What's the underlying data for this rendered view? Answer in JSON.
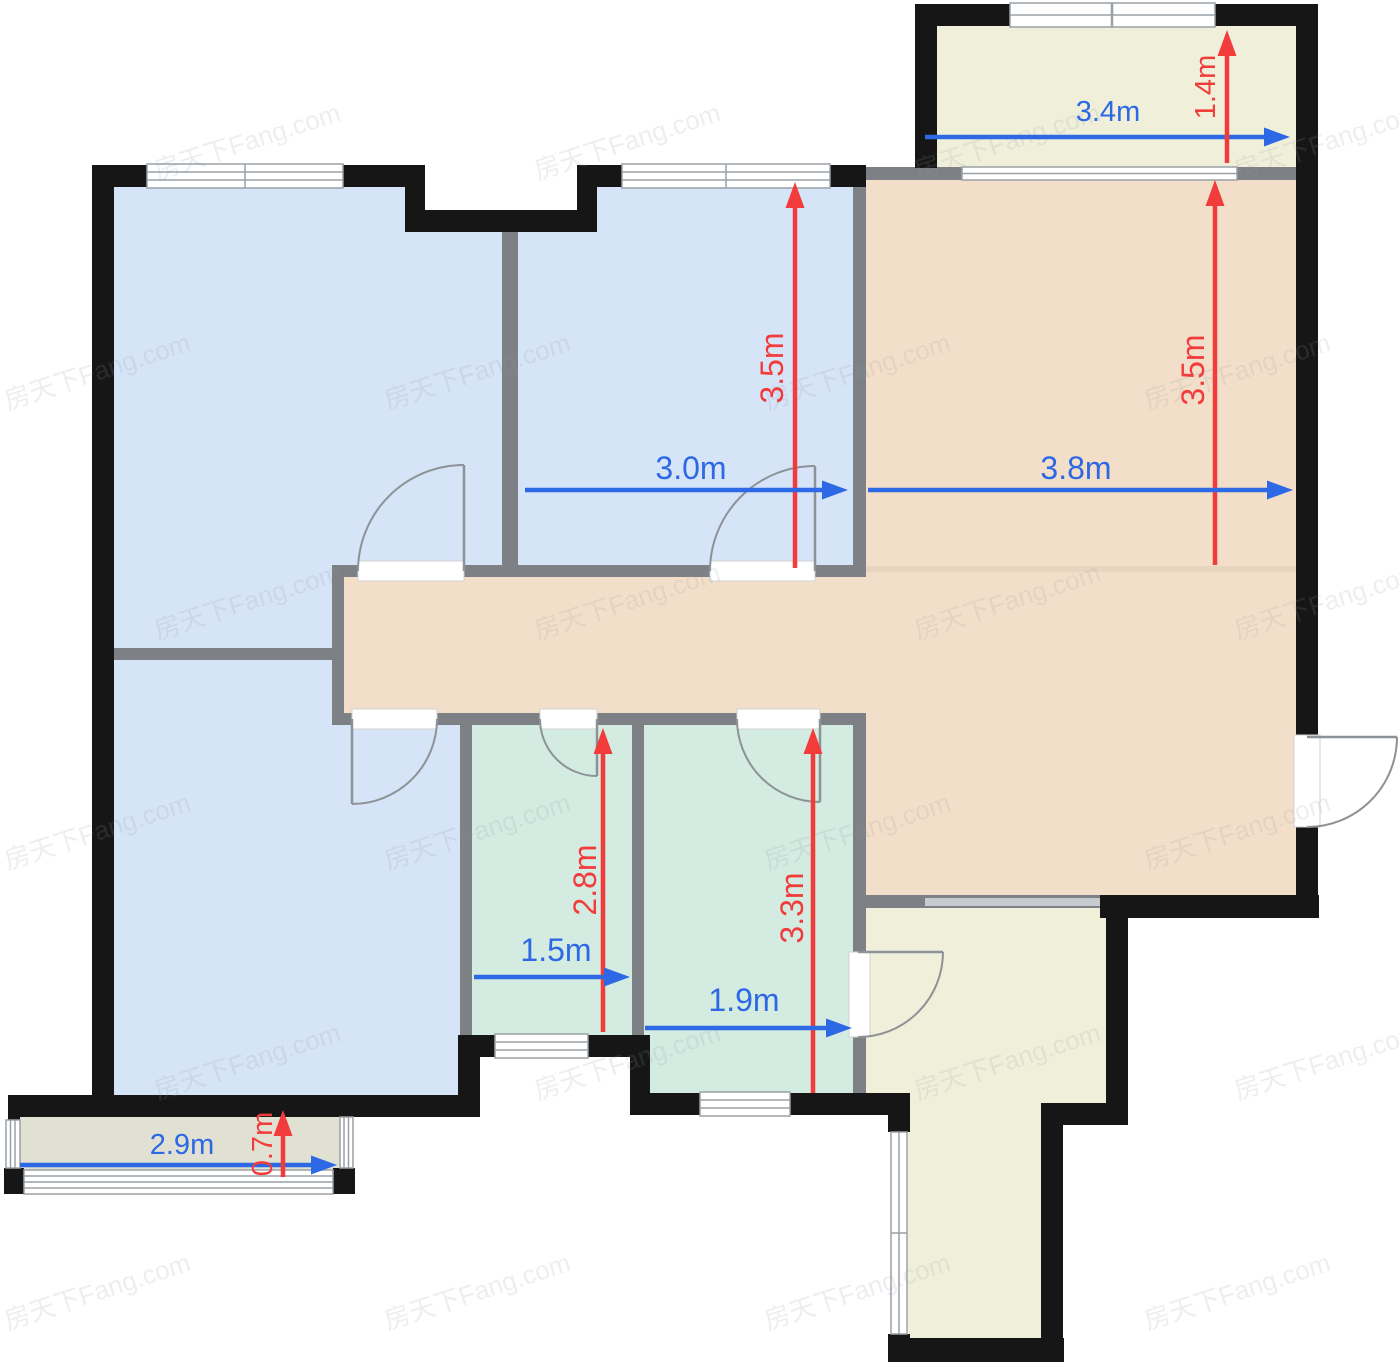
{
  "floorplan": {
    "watermark_text": "房天下Fang.com",
    "colors": {
      "wall": "#161616",
      "partition": "#7d8084",
      "partition_light": "#c6cbd0",
      "room_blue": "#d6e4f8",
      "room_tan": "#f3dfc9",
      "room_green": "#d3ebe0",
      "room_cream": "#f0f0da",
      "room_gray": "#e0e0d3",
      "dim_blue": "#2d68e5",
      "dim_red": "#f23c3c",
      "watermark": "#8f9aa8"
    },
    "dimensions": [
      {
        "id": "balcony-top-width",
        "label": "3.4m",
        "axis": "h",
        "x1": 925,
        "x2": 1290,
        "y": 137,
        "lx": 1108,
        "ly": 112,
        "color": "blue",
        "fs": 29
      },
      {
        "id": "balcony-top-depth",
        "label": "1.4m",
        "axis": "v",
        "x": 1227,
        "y1": 163,
        "y2": 30,
        "lx": 1206,
        "ly": 87,
        "color": "red",
        "fs": 29
      },
      {
        "id": "bedroom-mid-depth",
        "label": "3.5m",
        "axis": "v",
        "x": 795,
        "y1": 568,
        "y2": 182,
        "lx": 772,
        "ly": 368,
        "color": "red",
        "fs": 32
      },
      {
        "id": "bedroom-mid-width",
        "label": "3.0m",
        "axis": "h",
        "x1": 525,
        "x2": 848,
        "y": 490,
        "lx": 691,
        "ly": 468,
        "color": "blue",
        "fs": 32
      },
      {
        "id": "living-depth",
        "label": "3.5m",
        "axis": "v",
        "x": 1215,
        "y1": 565,
        "y2": 180,
        "lx": 1193,
        "ly": 370,
        "color": "red",
        "fs": 32
      },
      {
        "id": "living-width",
        "label": "3.8m",
        "axis": "h",
        "x1": 868,
        "x2": 1293,
        "y": 490,
        "lx": 1076,
        "ly": 468,
        "color": "blue",
        "fs": 32
      },
      {
        "id": "bath-left-depth",
        "label": "2.8m",
        "axis": "v",
        "x": 603,
        "y1": 1032,
        "y2": 728,
        "lx": 585,
        "ly": 880,
        "color": "red",
        "fs": 32
      },
      {
        "id": "bath-left-width",
        "label": "1.5m",
        "axis": "h",
        "x1": 474,
        "x2": 630,
        "y": 977,
        "lx": 556,
        "ly": 950,
        "color": "blue",
        "fs": 32
      },
      {
        "id": "bath-right-depth",
        "label": "3.3m",
        "axis": "v",
        "x": 813,
        "y1": 1093,
        "y2": 728,
        "lx": 792,
        "ly": 908,
        "color": "red",
        "fs": 32
      },
      {
        "id": "bath-right-width",
        "label": "1.9m",
        "axis": "h",
        "x1": 645,
        "x2": 852,
        "y": 1028,
        "lx": 744,
        "ly": 1000,
        "color": "blue",
        "fs": 32
      },
      {
        "id": "balcony-bottom-width",
        "label": "2.9m",
        "axis": "h",
        "x1": 20,
        "x2": 337,
        "y": 1165,
        "lx": 182,
        "ly": 1145,
        "color": "blue",
        "fs": 29
      },
      {
        "id": "balcony-bottom-depth",
        "label": "0.7m",
        "axis": "v",
        "x": 283,
        "y1": 1177,
        "y2": 1110,
        "lx": 263,
        "ly": 1144,
        "color": "red",
        "fs": 29
      }
    ]
  }
}
